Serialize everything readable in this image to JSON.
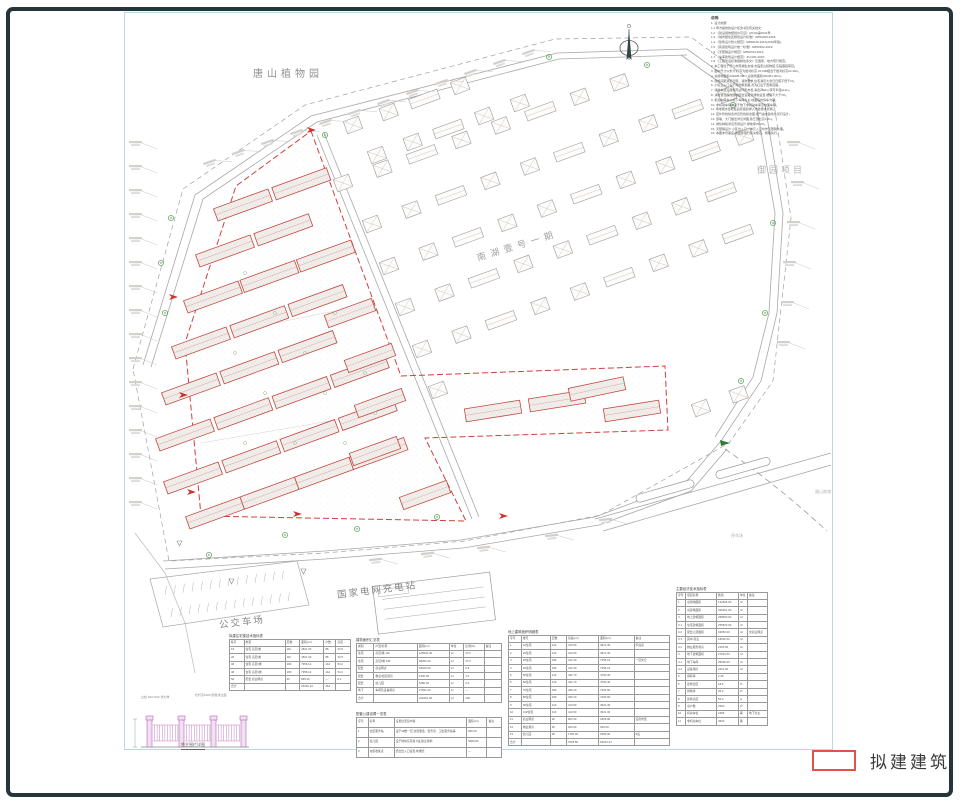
{
  "legend": {
    "proposed_building": "拟建建筑"
  },
  "labels": {
    "botanical_garden": "唐山植物园",
    "yuyuan_project": "御园项目",
    "nanhu_phase": "南湖壹号一期",
    "grid_charging_station": "国家电网充电站",
    "bus_depot": "公交车场",
    "tangshan_nanhu": "唐山南湖",
    "parking_area": "停车场"
  },
  "icons": {
    "north_arrow": "north-arrow-icon",
    "tree": "tree-icon",
    "entrance_marker": "entrance-marker-icon",
    "elevation_mark": "elevation-mark-icon"
  },
  "fence_detail": {
    "caption": "铁艺围栏详图",
    "note_left": "立柱 600×600 详大样",
    "note_right": "栏杆高1800 颜色详立面"
  },
  "notes": {
    "title": "说明:",
    "lines": [
      "1. 设计依据:",
      "1.1 甲方提供的设计任务书及有关批文;",
      "1.2 《建设用地规划许可证》(2019)第0031号;",
      "1.3 《城市居住区规划设计标准》GB50180-2018;",
      "1.4 《建筑设计防火规范》GB50016-2014(2018年版);",
      "1.5 《民用建筑设计统一标准》GB50352-2019;",
      "1.6 《无障碍设计规范》GB50763-2012;",
      "1.7 《车库建筑设计规范》JGJ100-2015;",
      "1.8 《工程建设标准强制性条文》及国家、地方现行规范。",
      "2. 本工程位于唐山市南湖生态城,北临唐山植物园,东临御园项目。",
      "3. 图中尺寸以米计,标高为绝对标高,±0.000相当于绝对标高22.30m。",
      "4. 总用地面积132606.00m²,总建筑面积326451.00m²。",
      "5. 建筑间距满足日照、消防要求,住宅满足大寒日日照不低于2h。",
      "6. 小区主入口设于南侧规划路,次入口设于西侧道路。",
      "7. 消防车道沿建筑周边环形布置,净宽≥4.0m,转弯半径≥12m。",
      "8. 消防登高操作场地结合道路及绿地设置,坡度不大于3%。",
      "9. 机动车停车以地下车库为主,地面临时停车为辅。",
      "10. 非机动车停车设于地下非机动车库及地面车棚。",
      "11. 场地雨水经收集后有组织排入市政雨水管网。",
      "12. 室外管线综合详见管线综合图,燃气由市政条件另行设计。",
      "13. 围墙、大门做法详见详图,铁艺围栏高1.8m。",
      "14. 绿化种植详见景观设计,绿地率35.2%。",
      "15. 无障碍设计:小区出入口、单元入口均作无障碍处理。",
      "16. 本图未尽事宜,按国家现行有关规范、规程执行。"
    ]
  },
  "tables": {
    "left": {
      "title": "拟建住宅楼技术指标表",
      "rows": [
        [
          "栋号",
          "类型",
          "层数",
          "面积(m²)",
          "户数",
          "高度"
        ],
        [
          "1#",
          "住宅 高层Ⅰ类",
          "11F",
          "4521.30",
          "88",
          "33.5"
        ],
        [
          "2#",
          "住宅 高层Ⅰ类",
          "11F",
          "4521.30",
          "88",
          "33.5"
        ],
        [
          "3#",
          "住宅 高层Ⅱ类",
          "18F",
          "7356.12",
          "144",
          "54.2"
        ],
        [
          "4#",
          "住宅 高层Ⅱ类",
          "18F",
          "7356.12",
          "144",
          "54.2"
        ],
        [
          "5#",
          "配套 商业网点",
          "2F",
          "865.40",
          "—",
          "8.1"
        ],
        [
          "合计",
          "",
          "",
          "24620.24",
          "464",
          ""
        ]
      ]
    },
    "mid_upper": {
      "title": "建筑面积汇总表",
      "rows": [
        [
          "类别",
          "户型/名称",
          "面积(m²)",
          "单位",
          "比例(%)",
          "备注"
        ],
        [
          "住宅",
          "高层Ⅰ类 11F",
          "126520.40",
          "m²",
          "47.6",
          ""
        ],
        [
          "住宅",
          "高层Ⅱ类 18F",
          "98350.20",
          "m²",
          "37.0",
          ""
        ],
        [
          "配套",
          "商业网点",
          "18020.00",
          "m²",
          "6.8",
          ""
        ],
        [
          "配套",
          "物业/社区用房",
          "4150.00",
          "m²",
          "1.6",
          ""
        ],
        [
          "配套",
          "幼儿园",
          "5280.00",
          "m²",
          "2.0",
          ""
        ],
        [
          "地下",
          "车库及设备用房",
          "27931.00",
          "m²",
          "—",
          ""
        ],
        [
          "合计",
          "",
          "326451.00",
          "m²",
          "100",
          ""
        ]
      ]
    },
    "mid_lower": {
      "title": "配套公建设置一览表",
      "rows": [
        [
          "序号",
          "名称",
          "设置位置及内容",
          "面积(m²)",
          "备注"
        ],
        [
          "1",
          "社区服务站",
          "设于3#楼一层,含居委会、警务室、卫生服务站等",
          "860.00",
          ""
        ],
        [
          "2",
          "幼儿园",
          "设于地块东南角,9班,独立用地",
          "5280.00",
          ""
        ],
        [
          "3",
          "垃圾收集点",
          "结合出入口设置,地埋式",
          "—",
          ""
        ]
      ]
    },
    "detail": {
      "title": "地上建筑面积明细表",
      "rows": [
        [
          "序号",
          "楼号",
          "层数",
          "基底(m²)",
          "面积(m²)",
          "备注"
        ],
        [
          "1",
          "1#住宅",
          "11F",
          "410.50",
          "4521.30",
          "带底商"
        ],
        [
          "2",
          "2#住宅",
          "11F",
          "410.50",
          "4521.30",
          ""
        ],
        [
          "3",
          "3#住宅",
          "18F",
          "412.30",
          "7356.12",
          "一层架空"
        ],
        [
          "4",
          "4#住宅",
          "18F",
          "412.30",
          "7356.12",
          ""
        ],
        [
          "5",
          "5#住宅",
          "11F",
          "432.70",
          "4760.40",
          ""
        ],
        [
          "6",
          "6#住宅",
          "11F",
          "432.70",
          "4760.40",
          ""
        ],
        [
          "7",
          "7#住宅",
          "18F",
          "405.20",
          "7293.60",
          ""
        ],
        [
          "8",
          "8#住宅",
          "18F",
          "405.20",
          "7293.60",
          ""
        ],
        [
          "9",
          "9#住宅",
          "11F",
          "410.50",
          "4521.30",
          ""
        ],
        [
          "10",
          "10#住宅",
          "11F",
          "410.50",
          "4521.30",
          ""
        ],
        [
          "11",
          "商业网点",
          "2F",
          "903.40",
          "1806.80",
          "沿街布置"
        ],
        [
          "12",
          "物业用房",
          "2F",
          "260.00",
          "520.00",
          ""
        ],
        [
          "13",
          "幼儿园",
          "3F",
          "1760.00",
          "5280.00",
          "9班"
        ],
        [
          "合计",
          "",
          "",
          "7065.80",
          "64512.24",
          ""
        ]
      ]
    },
    "indicators": {
      "title": "主要经济技术指标表",
      "rows": [
        [
          "序号",
          "项目名称",
          "数值",
          "单位",
          "备注"
        ],
        [
          "1",
          "总用地面积",
          "132606.00",
          "m²",
          ""
        ],
        [
          "2",
          "总建筑面积",
          "326451.00",
          "m²",
          ""
        ],
        [
          "3",
          "地上建筑面积",
          "298520.00",
          "m²",
          ""
        ],
        [
          "3.1",
          "住宅建筑面积",
          "265870.00",
          "m²",
          ""
        ],
        [
          "3.2",
          "配套公建面积",
          "32650.00",
          "m²",
          "含商业网点"
        ],
        [
          "3.3",
          "其中:商业",
          "18020.00",
          "m²",
          ""
        ],
        [
          "3.4",
          "物业服务用房",
          "2150.00",
          "m²",
          ""
        ],
        [
          "4",
          "地下建筑面积",
          "27931.00",
          "m²",
          ""
        ],
        [
          "4.1",
          "地下车库",
          "25600.00",
          "m²",
          ""
        ],
        [
          "4.2",
          "设备用房",
          "2331.00",
          "m²",
          ""
        ],
        [
          "5",
          "容积率",
          "2.25",
          "",
          ""
        ],
        [
          "6",
          "建筑密度",
          "18.6",
          "%",
          ""
        ],
        [
          "7",
          "绿地率",
          "35.2",
          "%",
          ""
        ],
        [
          "8",
          "建筑高度",
          "54.3",
          "m",
          ""
        ],
        [
          "9",
          "总户数",
          "2260",
          "户",
          ""
        ],
        [
          "10",
          "机动车位",
          "2486",
          "辆",
          "地下为主"
        ],
        [
          "11",
          "非机动车位",
          "4520",
          "辆",
          ""
        ]
      ]
    }
  }
}
